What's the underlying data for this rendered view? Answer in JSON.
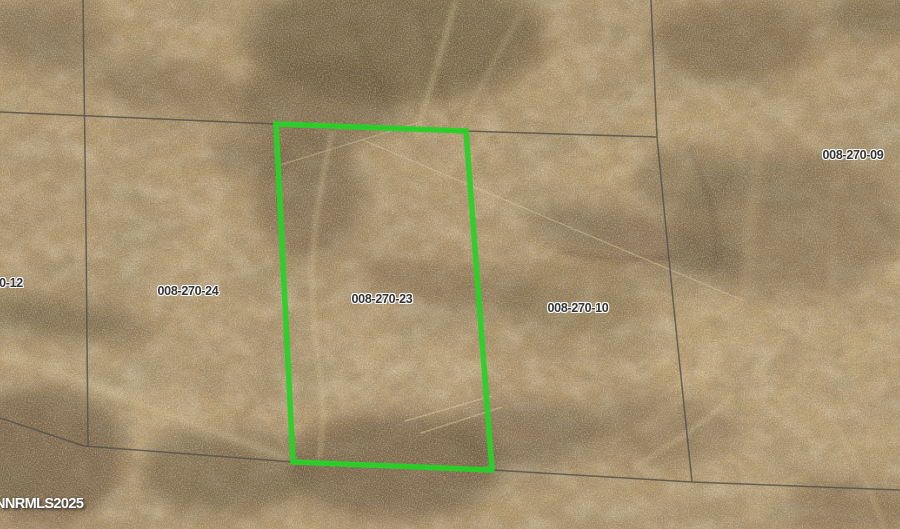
{
  "map": {
    "watermark": "NNRMLS2025",
    "highlighted_parcel_label": "008-270-23",
    "parcel_labels": [
      {
        "text": "0-12"
      },
      {
        "text": "008-270-24"
      },
      {
        "text": "008-270-23"
      },
      {
        "text": "008-270-10"
      },
      {
        "text": "008-270-09"
      }
    ],
    "colors": {
      "terrain_base": "#b3966b",
      "parcel_line": "#56524b",
      "highlight_outline": "#28d228",
      "label_text": "#333333",
      "label_halo": "#ffffff",
      "watermark_text": "#ffffff"
    }
  }
}
